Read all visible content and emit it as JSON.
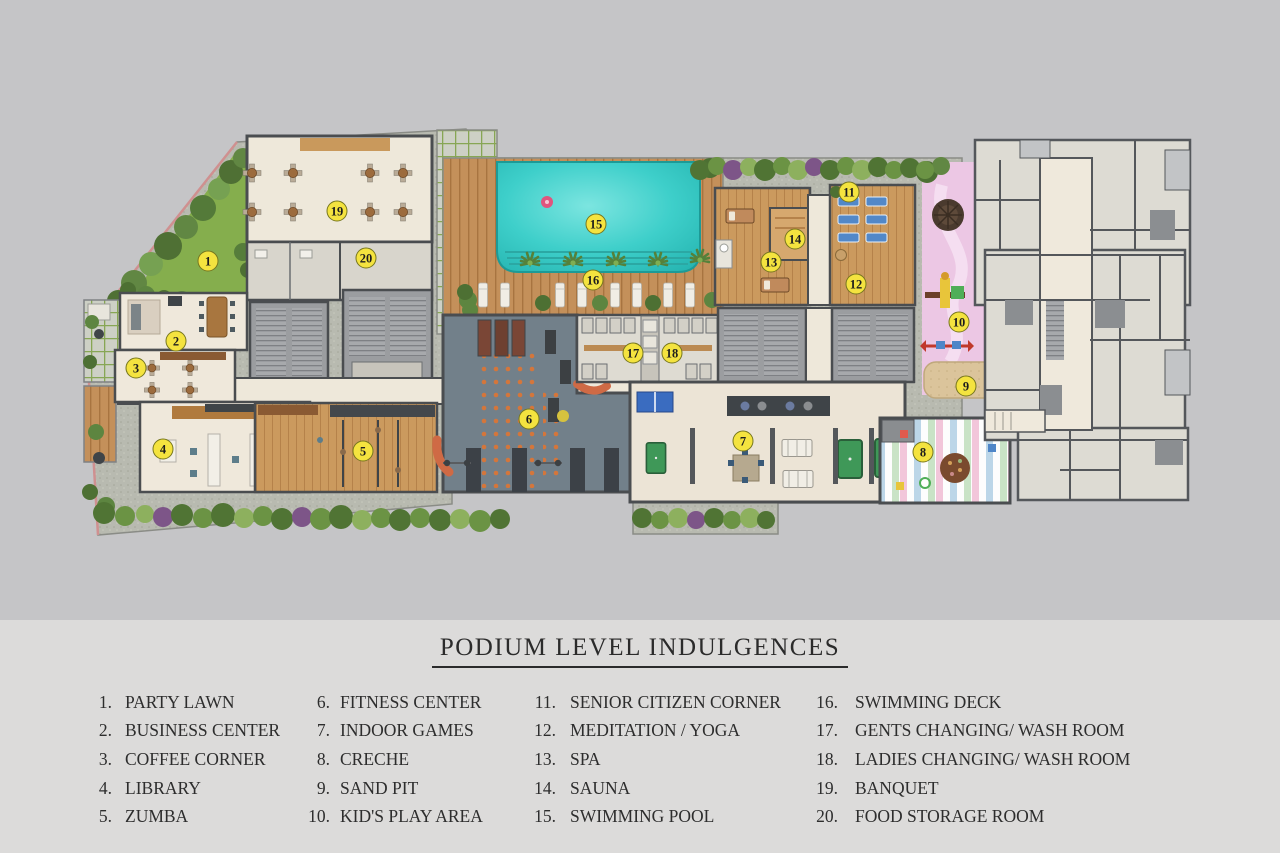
{
  "title": "PODIUM LEVEL INDULGENCES",
  "legend": {
    "columns": [
      {
        "items": [
          {
            "num": "1.",
            "label": "PARTY LAWN"
          },
          {
            "num": "2.",
            "label": "BUSINESS CENTER"
          },
          {
            "num": "3.",
            "label": "COFFEE CORNER"
          },
          {
            "num": "4.",
            "label": "LIBRARY"
          },
          {
            "num": "5.",
            "label": "ZUMBA"
          }
        ]
      },
      {
        "items": [
          {
            "num": "6.",
            "label": "FITNESS CENTER"
          },
          {
            "num": "7.",
            "label": "INDOOR GAMES"
          },
          {
            "num": "8.",
            "label": "CRECHE"
          },
          {
            "num": "9.",
            "label": "SAND PIT"
          },
          {
            "num": "10.",
            "label": "KID'S PLAY AREA"
          }
        ]
      },
      {
        "items": [
          {
            "num": "11.",
            "label": "SENIOR CITIZEN CORNER"
          },
          {
            "num": "12.",
            "label": "MEDITATION / YOGA"
          },
          {
            "num": "13.",
            "label": "SPA"
          },
          {
            "num": "14.",
            "label": "SAUNA"
          },
          {
            "num": "15.",
            "label": "SWIMMING POOL"
          }
        ]
      },
      {
        "items": [
          {
            "num": "16.",
            "label": "SWIMMING DECK"
          },
          {
            "num": "17.",
            "label": "GENTS CHANGING/ WASH ROOM"
          },
          {
            "num": "18.",
            "label": "LADIES CHANGING/ WASH ROOM"
          },
          {
            "num": "19.",
            "label": "BANQUET"
          },
          {
            "num": "20.",
            "label": "FOOD STORAGE ROOM"
          }
        ]
      }
    ]
  },
  "plan": {
    "markers": [
      "1",
      "2",
      "3",
      "4",
      "5",
      "6",
      "7",
      "8",
      "9",
      "10",
      "11",
      "12",
      "13",
      "14",
      "15",
      "16",
      "17",
      "18",
      "19",
      "20"
    ]
  },
  "colors": {
    "background": "#c5c5c7",
    "legend_background": "#dcdbda",
    "marker_yellow": "#f4e33f",
    "pool_water": "#3ecfca",
    "lawn_green": "#85ae4d",
    "deck_wood": "#c4905a",
    "fitness_floor": "#72808a",
    "kids_area_pink": "#ecc7e4",
    "sand": "#dbc49b",
    "text": "#2d2d2d"
  }
}
